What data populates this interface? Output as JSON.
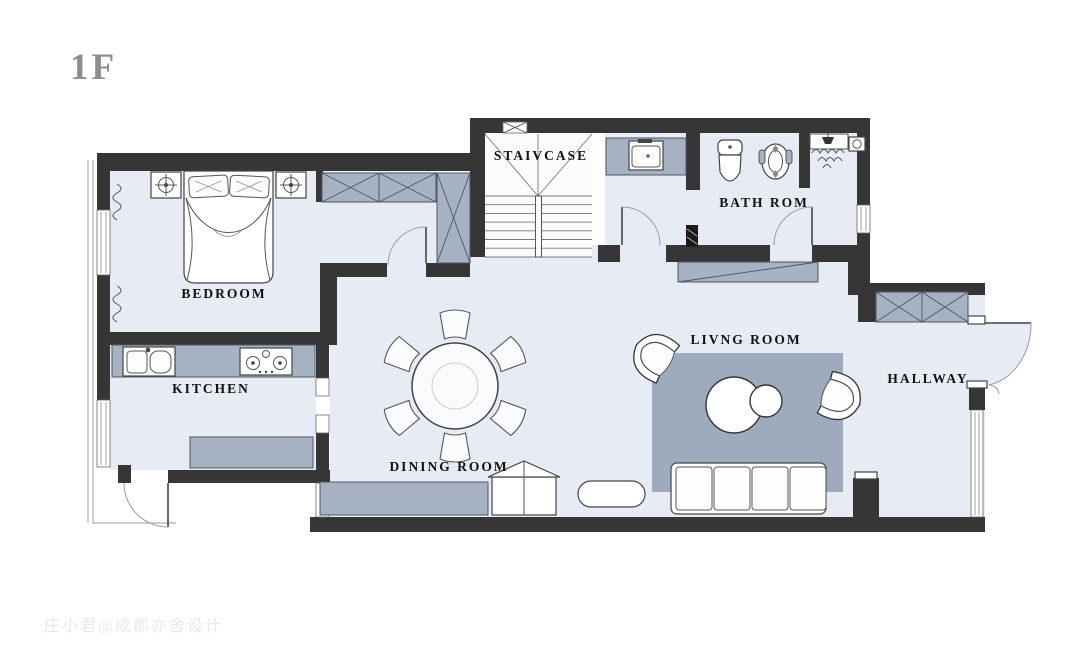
{
  "page": {
    "floor_label": "1F",
    "watermark": "庄小君@成都亦舍设计"
  },
  "rooms": {
    "bedroom": "BEDROOM",
    "kitchen": "KITCHEN",
    "staircase": "STAIVCASE",
    "bathroom": "BATH ROM",
    "living_room": "LIVNG ROOM",
    "dining_room": "DINING ROOM",
    "hallway": "HALLWAY"
  },
  "colors": {
    "background": "#ffffff",
    "wall": "#363636",
    "floor": "#e7ebf3",
    "staircase_floor": "#fcfcfd",
    "furniture_gray": "#a6b2c2",
    "wardrobe_gray": "#9fb0c3",
    "rug_gray": "#9dabbd",
    "room_label_text": "#111111",
    "floor_label_gray": "#8d8d8d",
    "watermark_gray": "#e9e9e9"
  },
  "symbols": [
    "double-bed",
    "pillow",
    "nightstand",
    "ceiling-lamp",
    "wardrobe",
    "radiator-coil",
    "kitchen-sink",
    "gas-stove",
    "kitchen-island",
    "staircase-steps",
    "washbasin",
    "toilet",
    "bidet",
    "shower-head",
    "corner-sink",
    "dining-table",
    "dining-chair",
    "rug",
    "coffee-table",
    "armchair",
    "sofa",
    "tv-console",
    "pet-house",
    "bench-stool",
    "entry-wardrobe",
    "sideboard",
    "door-arc",
    "window",
    "pillar"
  ]
}
